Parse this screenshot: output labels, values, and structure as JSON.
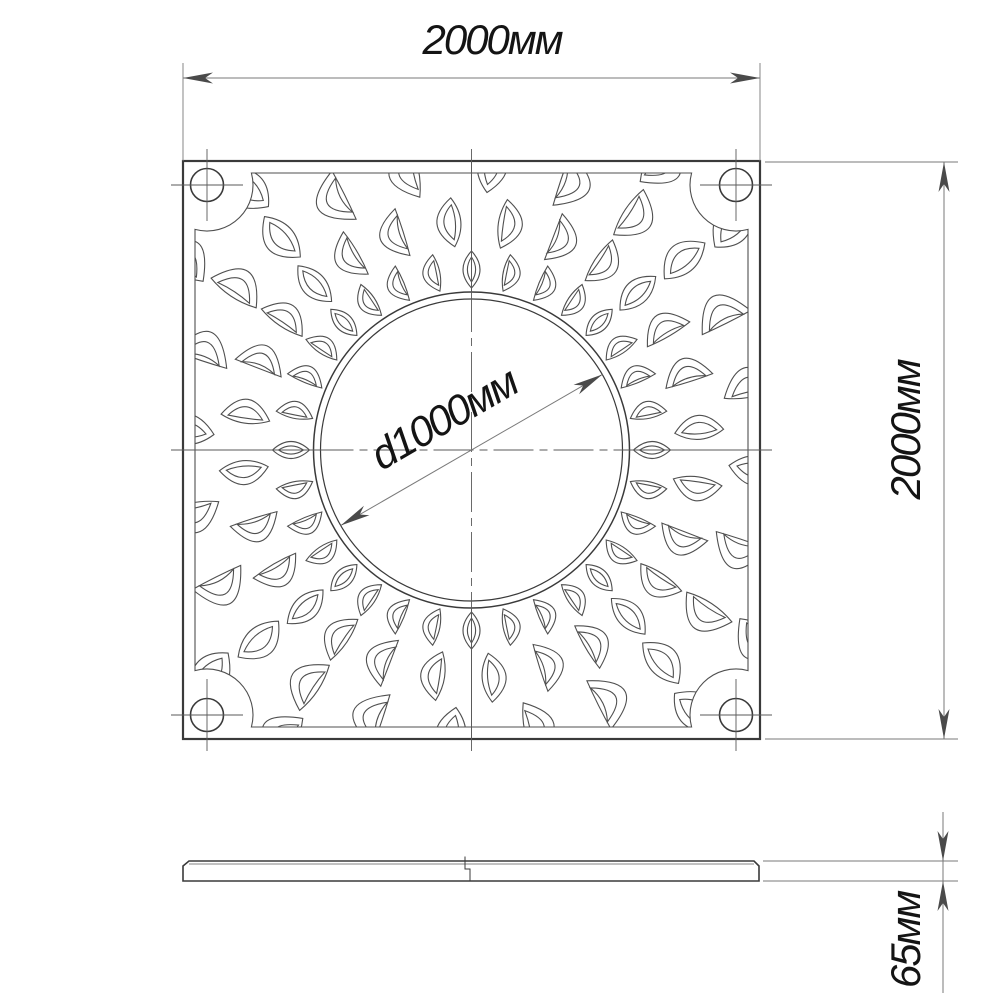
{
  "page": {
    "background": "#ffffff"
  },
  "drawing": {
    "kind": "tree-grate technical drawing, plan view and side view",
    "colors": {
      "outline": "#3a3a3a",
      "pattern": "#4f4f4f",
      "dimension_line": "#7a7a7a",
      "arrow": "#4a4a4a",
      "text": "#141414",
      "background": "#ffffff"
    },
    "plan_view": {
      "shape": "square plate with decorative leaf perforation",
      "bolt_hole_count": "4",
      "width_dimension": {
        "label": "2000мм",
        "value": 2000,
        "unit": "мм"
      },
      "height_dimension": {
        "label": "2000мм",
        "value": 2000,
        "unit": "мм"
      },
      "center_hole": {
        "label": "d1000мм",
        "value": 1000,
        "unit": "мм"
      }
    },
    "side_view": {
      "thickness_dimension": {
        "label": "65мм",
        "value": 65,
        "unit": "мм"
      }
    }
  }
}
